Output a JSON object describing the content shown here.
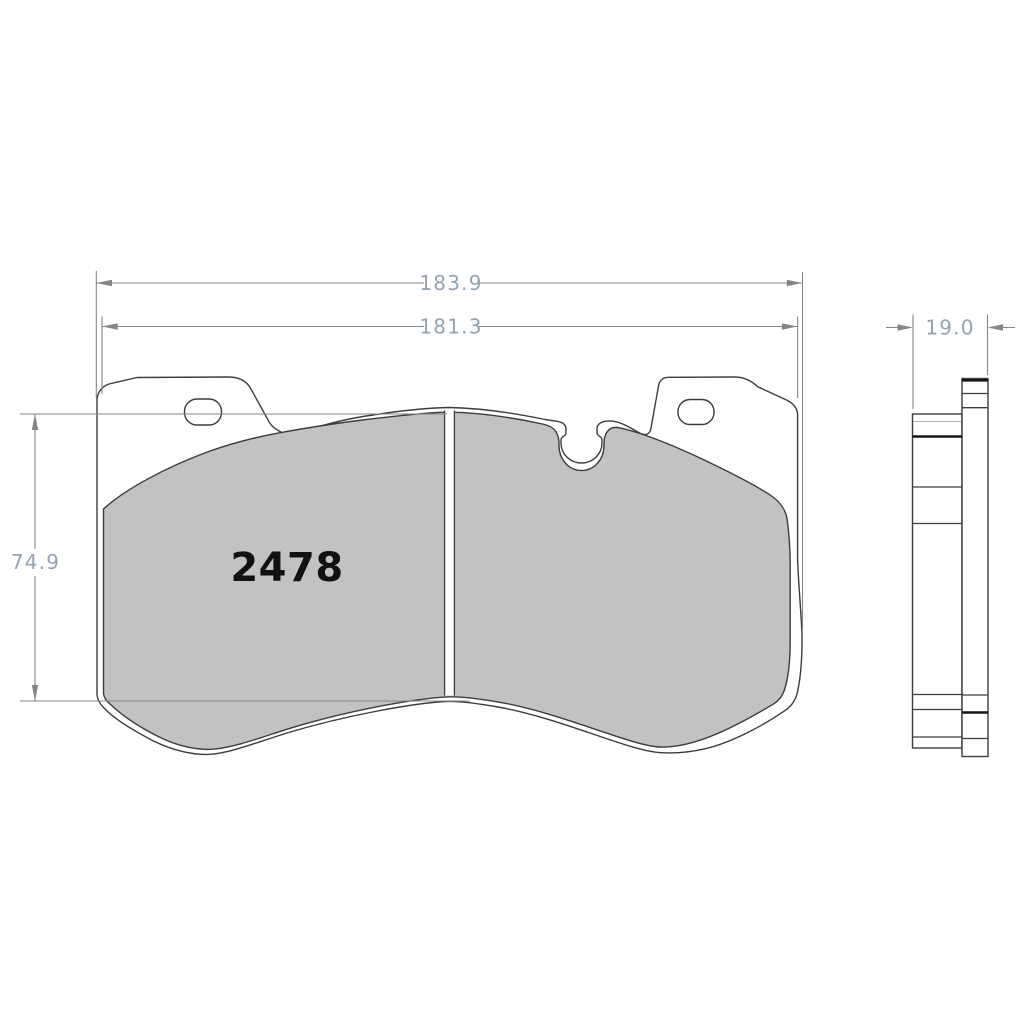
{
  "drawing": {
    "part_number": "2478",
    "dimensions": {
      "overall_width": "183.9",
      "pad_width": "181.3",
      "pad_height": "74.9",
      "thickness": "19.0"
    },
    "colors": {
      "background": "#ffffff",
      "outline_color": "#3c3c3c",
      "friction_fill": "#c2c2c2",
      "dimension_line": "#868686",
      "dimension_text": "#94a2b1",
      "part_number_text": "#111111"
    }
  }
}
